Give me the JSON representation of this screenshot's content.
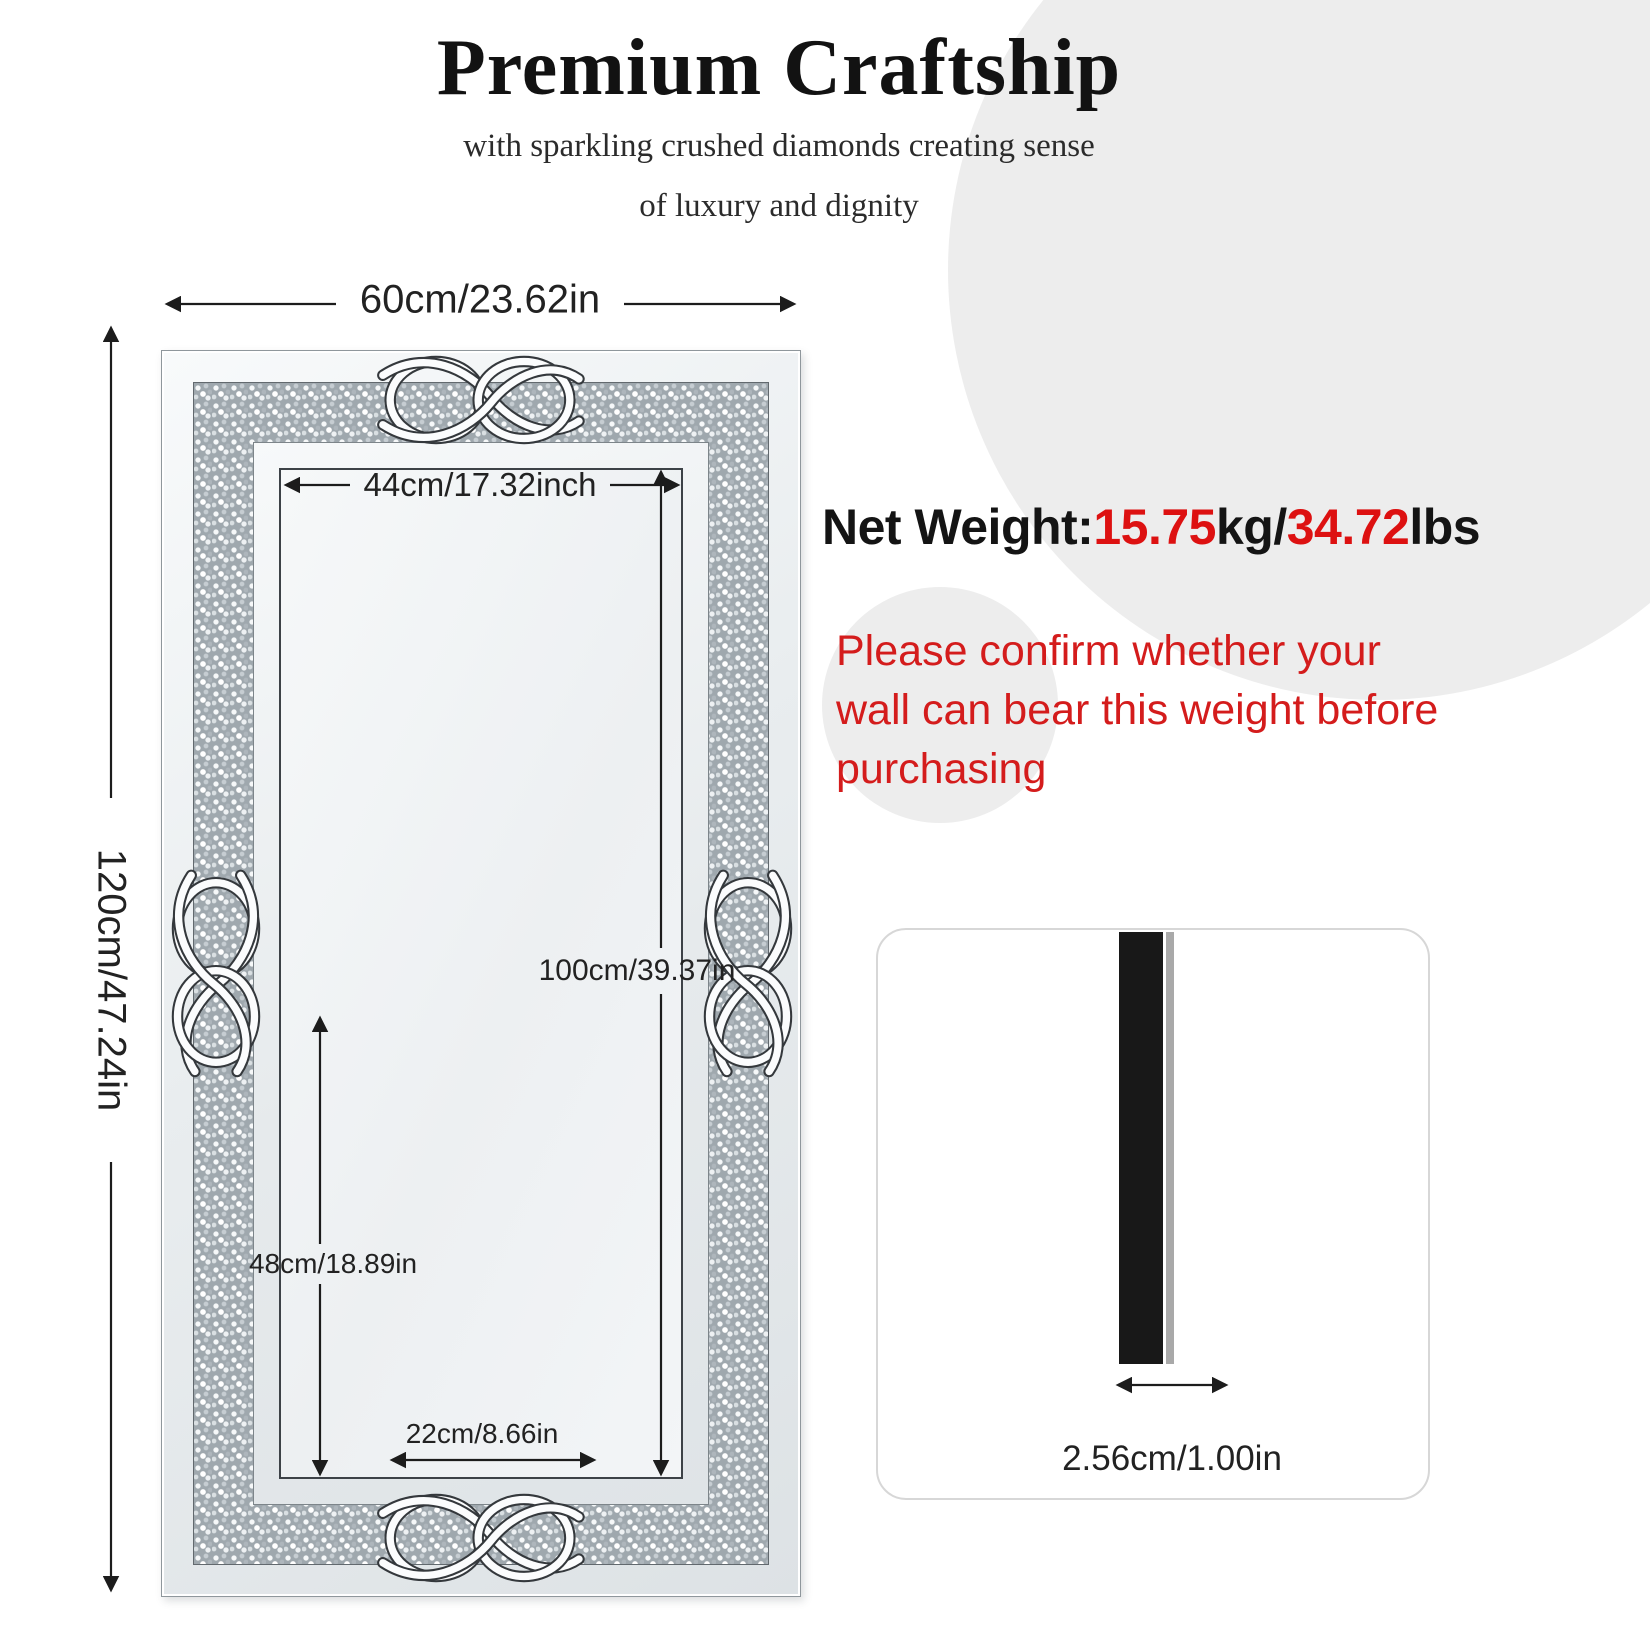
{
  "header": {
    "title": "Premium Craftship",
    "subtitle_line1": "with sparkling crushed diamonds creating sense",
    "subtitle_line2": "of luxury and dignity"
  },
  "dimensions": {
    "overall_width": "60cm/23.62in",
    "overall_height": "120cm/47.24in",
    "inner_width": "44cm/17.32inch",
    "inner_height": "100cm/39.37in",
    "partial_height": "48cm/18.89in",
    "partial_width": "22cm/8.66in",
    "thickness": "2.56cm/1.00in"
  },
  "net_weight": {
    "label": "Net Weight:",
    "kg_value": "15.75",
    "kg_unit": "kg/",
    "lbs_value": "34.72",
    "lbs_unit": "lbs"
  },
  "warning_lines": [
    "Please confirm whether your",
    "wall can bear this weight before",
    "purchasing"
  ],
  "colors": {
    "accent_red": "#dd1111",
    "warning_red": "#d41c1c",
    "circle_gray": "#ededed",
    "line_dark": "#1c1c1c"
  }
}
